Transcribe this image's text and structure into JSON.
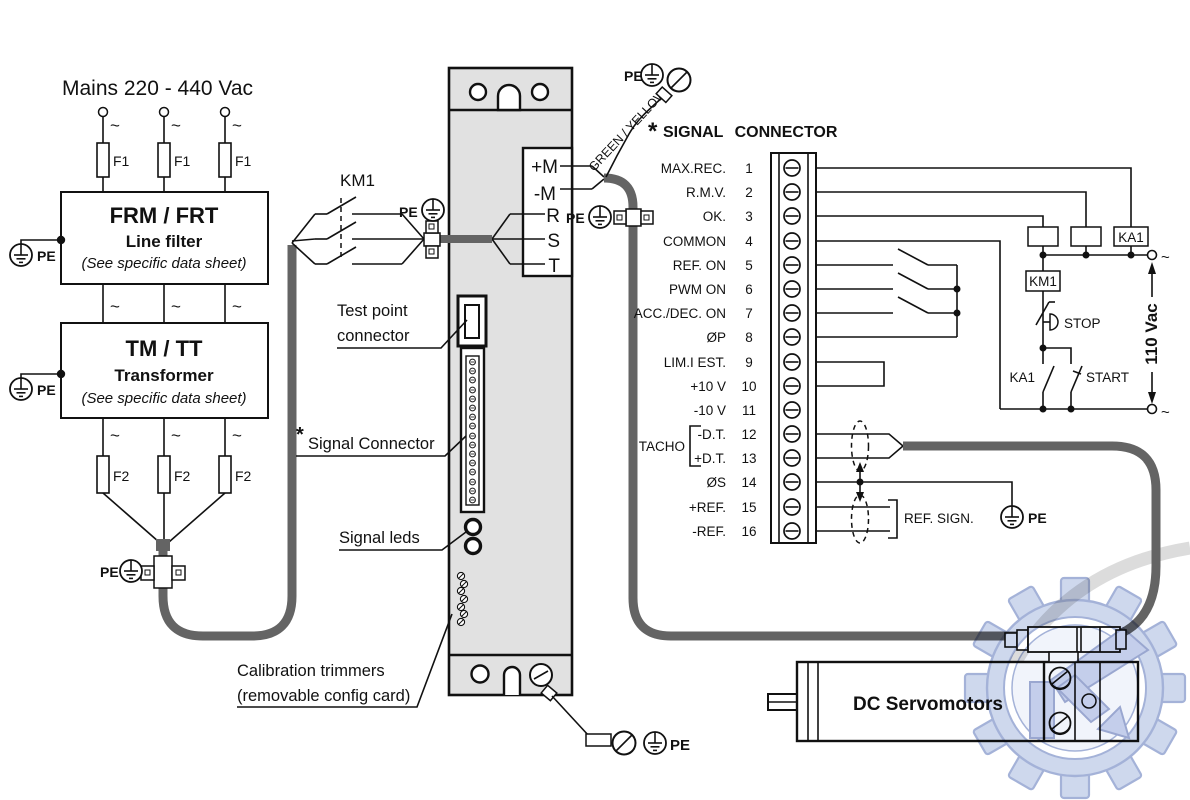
{
  "symbols": {
    "ac": "~",
    "asterisk": "*"
  },
  "labels": {
    "pe": "PE",
    "km1": "KM1",
    "green_yellow": "GREEN / YELLOW",
    "f1": "F1",
    "f2": "F2"
  },
  "mains": {
    "title": "Mains 220 - 440 Vac"
  },
  "line_filter": {
    "title": "FRM / FRT",
    "subtitle": "Line filter",
    "note": "(See specific data sheet)"
  },
  "transformer": {
    "title": "TM / TT",
    "subtitle": "Transformer",
    "note": "(See specific data sheet)"
  },
  "drive": {
    "terminals": [
      "+M",
      "-M",
      "R",
      "S",
      "T"
    ],
    "callouts": {
      "test_point_1": "Test point",
      "test_point_2": "connector",
      "signal_connector": "Signal Connector",
      "signal_leds": "Signal leds",
      "calibration_1": "Calibration trimmers",
      "calibration_2": "(removable config card)"
    }
  },
  "signal": {
    "heading": "SIGNAL CONNECTOR",
    "tacho": "TACHO",
    "ref_sign": "REF. SIGN.",
    "pins": [
      {
        "label": "MAX.REC.",
        "n": "1"
      },
      {
        "label": "R.M.V.",
        "n": "2"
      },
      {
        "label": "OK.",
        "n": "3"
      },
      {
        "label": "COMMON",
        "n": "4"
      },
      {
        "label": "REF. ON",
        "n": "5"
      },
      {
        "label": "PWM ON",
        "n": "6"
      },
      {
        "label": "ACC./DEC. ON",
        "n": "7"
      },
      {
        "label": "ØP",
        "n": "8"
      },
      {
        "label": "LIM.I EST.",
        "n": "9"
      },
      {
        "label": "+10 V",
        "n": "10"
      },
      {
        "label": "-10 V",
        "n": "11"
      },
      {
        "label": "-D.T.",
        "n": "12"
      },
      {
        "label": "+D.T.",
        "n": "13"
      },
      {
        "label": "ØS",
        "n": "14"
      },
      {
        "label": "+REF.",
        "n": "15"
      },
      {
        "label": "-REF.",
        "n": "16"
      }
    ]
  },
  "control": {
    "relay_ka1": "KA1",
    "coil_km1": "KM1",
    "stop": "STOP",
    "contact_ka1": "KA1",
    "start": "START",
    "supply": "110 Vac"
  },
  "motor": {
    "label": "DC Servomotors"
  },
  "colors": {
    "cable": "#646464",
    "module_fill": "#e1e1e1",
    "line": "#111111",
    "watermark_blue": "#8d9fce",
    "watermark_fill": "#c2cee9"
  }
}
